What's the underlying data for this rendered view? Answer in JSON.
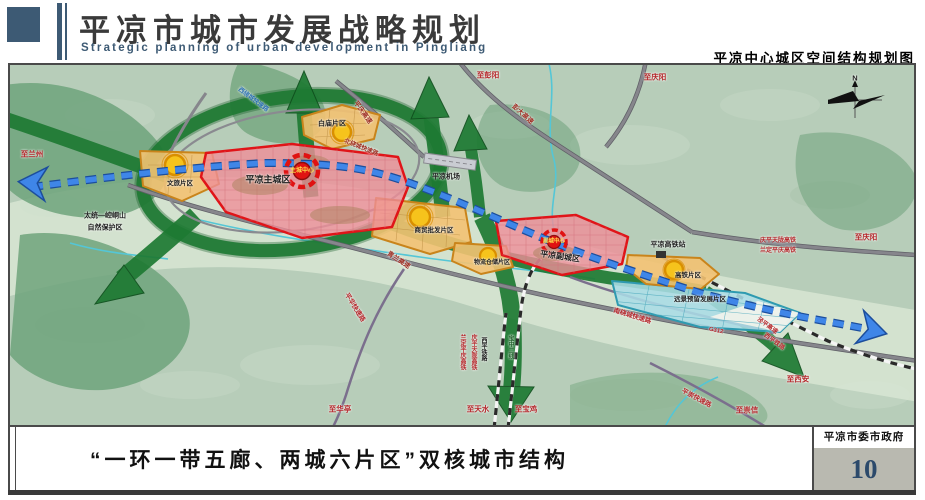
{
  "header": {
    "title": "平凉市城市发展战略规划",
    "subtitle": "Strategic planning of urban development in Pingliang",
    "map_title": "平凉中心城区空间结构规划图"
  },
  "footer": {
    "caption": "“一环一带五廊、两城六片区”双核城市结构",
    "agency": "平凉市委市政府",
    "page_number": "10"
  },
  "colors": {
    "header_blue": "#3d5a74",
    "page_number_blue": "#2c4a6b",
    "core_red": "#e01212",
    "zone_pink": "#ef8f99",
    "zone_orange": "#f3c272",
    "zone_cyan": "#aadce6",
    "corridor_green": "#1e7a33",
    "axis_blue": "#3f86e8"
  },
  "map": {
    "label_colors": {
      "red": "#b5282c",
      "darkred": "#9c2b20",
      "black": "#1d1d1d",
      "yellow": "#ffe14d",
      "blue": "#2a6fb0",
      "green": "#23632e"
    },
    "labels": [
      {
        "name": "label-to-lanzhou",
        "text": "至兰州",
        "x": 22,
        "y": 89,
        "color": "red",
        "size": 7.5
      },
      {
        "name": "label-to-pengyang",
        "text": "至彭阳",
        "x": 478,
        "y": 10,
        "color": "red",
        "size": 7.5
      },
      {
        "name": "label-to-qingyang-top",
        "text": "至庆阳",
        "x": 645,
        "y": 12,
        "color": "red",
        "size": 7.5
      },
      {
        "name": "label-to-qingyang-east",
        "text": "至庆阳",
        "x": 856,
        "y": 172,
        "color": "red",
        "size": 7.5
      },
      {
        "name": "label-to-xian",
        "text": "至西安",
        "x": 788,
        "y": 314,
        "color": "red",
        "size": 7.5
      },
      {
        "name": "label-to-chongxin",
        "text": "至崇信",
        "x": 737,
        "y": 345,
        "color": "red",
        "size": 7.5
      },
      {
        "name": "label-to-baoji",
        "text": "至宝鸡",
        "x": 516,
        "y": 344,
        "color": "red",
        "size": 7.5
      },
      {
        "name": "label-to-tianshui",
        "text": "至天水",
        "x": 468,
        "y": 344,
        "color": "red",
        "size": 7.5
      },
      {
        "name": "label-to-huating",
        "text": "至华亭",
        "x": 330,
        "y": 344,
        "color": "red",
        "size": 7.5
      },
      {
        "name": "label-pengda-expwy",
        "text": "彭大高速",
        "x": 512,
        "y": 50,
        "color": "darkred",
        "size": 6.5,
        "rot": 42
      },
      {
        "name": "label-pingqing-expwy",
        "text": "平庆高速",
        "x": 352,
        "y": 48,
        "color": "darkred",
        "size": 6.5,
        "rot": 54
      },
      {
        "name": "label-west-ring",
        "text": "西绕城快速路",
        "x": 243,
        "y": 35,
        "color": "blue",
        "size": 6,
        "rot": 37
      },
      {
        "name": "label-north-ring",
        "text": "北绕城快速路",
        "x": 351,
        "y": 83,
        "color": "darkred",
        "size": 6,
        "rot": 22
      },
      {
        "name": "label-qinglan-expwy",
        "text": "青兰高速",
        "x": 388,
        "y": 196,
        "color": "darkred",
        "size": 6.5,
        "rot": 33
      },
      {
        "name": "label-south-ring",
        "text": "南绕城快速路",
        "x": 622,
        "y": 252,
        "color": "red",
        "size": 6.5,
        "rot": 17
      },
      {
        "name": "label-g312",
        "text": "G312",
        "x": 706,
        "y": 266,
        "color": "red",
        "size": 6,
        "rot": 12
      },
      {
        "name": "label-jingping-expwy",
        "text": "泾平高速",
        "x": 757,
        "y": 261,
        "color": "red",
        "size": 6,
        "rot": 36
      },
      {
        "name": "label-xiping-rail-east",
        "text": "西平铁路",
        "x": 764,
        "y": 277,
        "color": "red",
        "size": 6,
        "rot": 36
      },
      {
        "name": "label-pingchong-expwy",
        "text": "平崇快速路",
        "x": 686,
        "y": 334,
        "color": "red",
        "size": 6.5,
        "rot": 28
      },
      {
        "name": "label-pinghua-expwy",
        "text": "平华快速路",
        "x": 344,
        "y": 243,
        "color": "red",
        "size": 6.5,
        "rot": 58
      },
      {
        "name": "label-landing-hsr",
        "text": "兰定平庆高铁",
        "x": 452,
        "y": 287,
        "color": "red",
        "size": 6,
        "vertical": true
      },
      {
        "name": "label-qingping-hsr",
        "text": "庆平天陇高铁",
        "x": 463,
        "y": 287,
        "color": "red",
        "size": 6,
        "vertical": true
      },
      {
        "name": "label-xiping-rail",
        "text": "西平铁路",
        "x": 473,
        "y": 284,
        "color": "black",
        "size": 6,
        "vertical": true
      },
      {
        "name": "label-baozhong-rail",
        "text": "宝中二线",
        "x": 500,
        "y": 282,
        "color": "green",
        "size": 6,
        "vertical": true
      },
      {
        "name": "label-qingping-hsr-2",
        "text": "庆平天陇高铁",
        "x": 768,
        "y": 176,
        "color": "red",
        "size": 6
      },
      {
        "name": "label-landing-hsr-2",
        "text": "兰定平庆高铁",
        "x": 768,
        "y": 186,
        "color": "red",
        "size": 6
      },
      {
        "name": "label-airport",
        "text": "平凉机场",
        "x": 436,
        "y": 112,
        "color": "black",
        "size": 7
      },
      {
        "name": "label-hsr-station",
        "text": "平凉高铁站",
        "x": 658,
        "y": 180,
        "color": "black",
        "size": 7
      },
      {
        "name": "label-nature-reserve-1",
        "text": "太统—崆峒山",
        "x": 95,
        "y": 151,
        "color": "black",
        "size": 7
      },
      {
        "name": "label-nature-reserve-2",
        "text": "自然保护区",
        "x": 95,
        "y": 163,
        "color": "black",
        "size": 7
      },
      {
        "name": "label-zone-baimiao",
        "text": "白庙片区",
        "x": 322,
        "y": 59,
        "color": "black",
        "size": 7
      },
      {
        "name": "label-zone-wenlv",
        "text": "文旅片区",
        "x": 170,
        "y": 119,
        "color": "black",
        "size": 6.5
      },
      {
        "name": "label-main-city",
        "text": "平凉主城区",
        "x": 258,
        "y": 115,
        "color": "black",
        "size": 9
      },
      {
        "name": "label-main-core",
        "text": "主城中心",
        "x": 292,
        "y": 106,
        "color": "yellow",
        "size": 6,
        "halo": false
      },
      {
        "name": "label-zone-shangmao",
        "text": "商贸批发片区",
        "x": 424,
        "y": 166,
        "color": "black",
        "size": 6.5
      },
      {
        "name": "label-zone-wuliu",
        "text": "物流仓储片区",
        "x": 482,
        "y": 198,
        "color": "black",
        "size": 6
      },
      {
        "name": "label-sub-city",
        "text": "平凉副城区",
        "x": 550,
        "y": 192,
        "color": "black",
        "size": 8,
        "rot": 8
      },
      {
        "name": "label-sub-core",
        "text": "副城中心",
        "x": 544,
        "y": 177,
        "color": "yellow",
        "size": 5.5,
        "halo": false
      },
      {
        "name": "label-zone-gaotie",
        "text": "高铁片区",
        "x": 678,
        "y": 211,
        "color": "black",
        "size": 6.5
      },
      {
        "name": "label-zone-yuanjing",
        "text": "远景预留发展片区",
        "x": 690,
        "y": 235,
        "color": "black",
        "size": 6.5
      },
      {
        "name": "label-compass-n",
        "text": "N",
        "x": 845,
        "y": 13,
        "color": "black",
        "size": 7.5
      }
    ]
  }
}
